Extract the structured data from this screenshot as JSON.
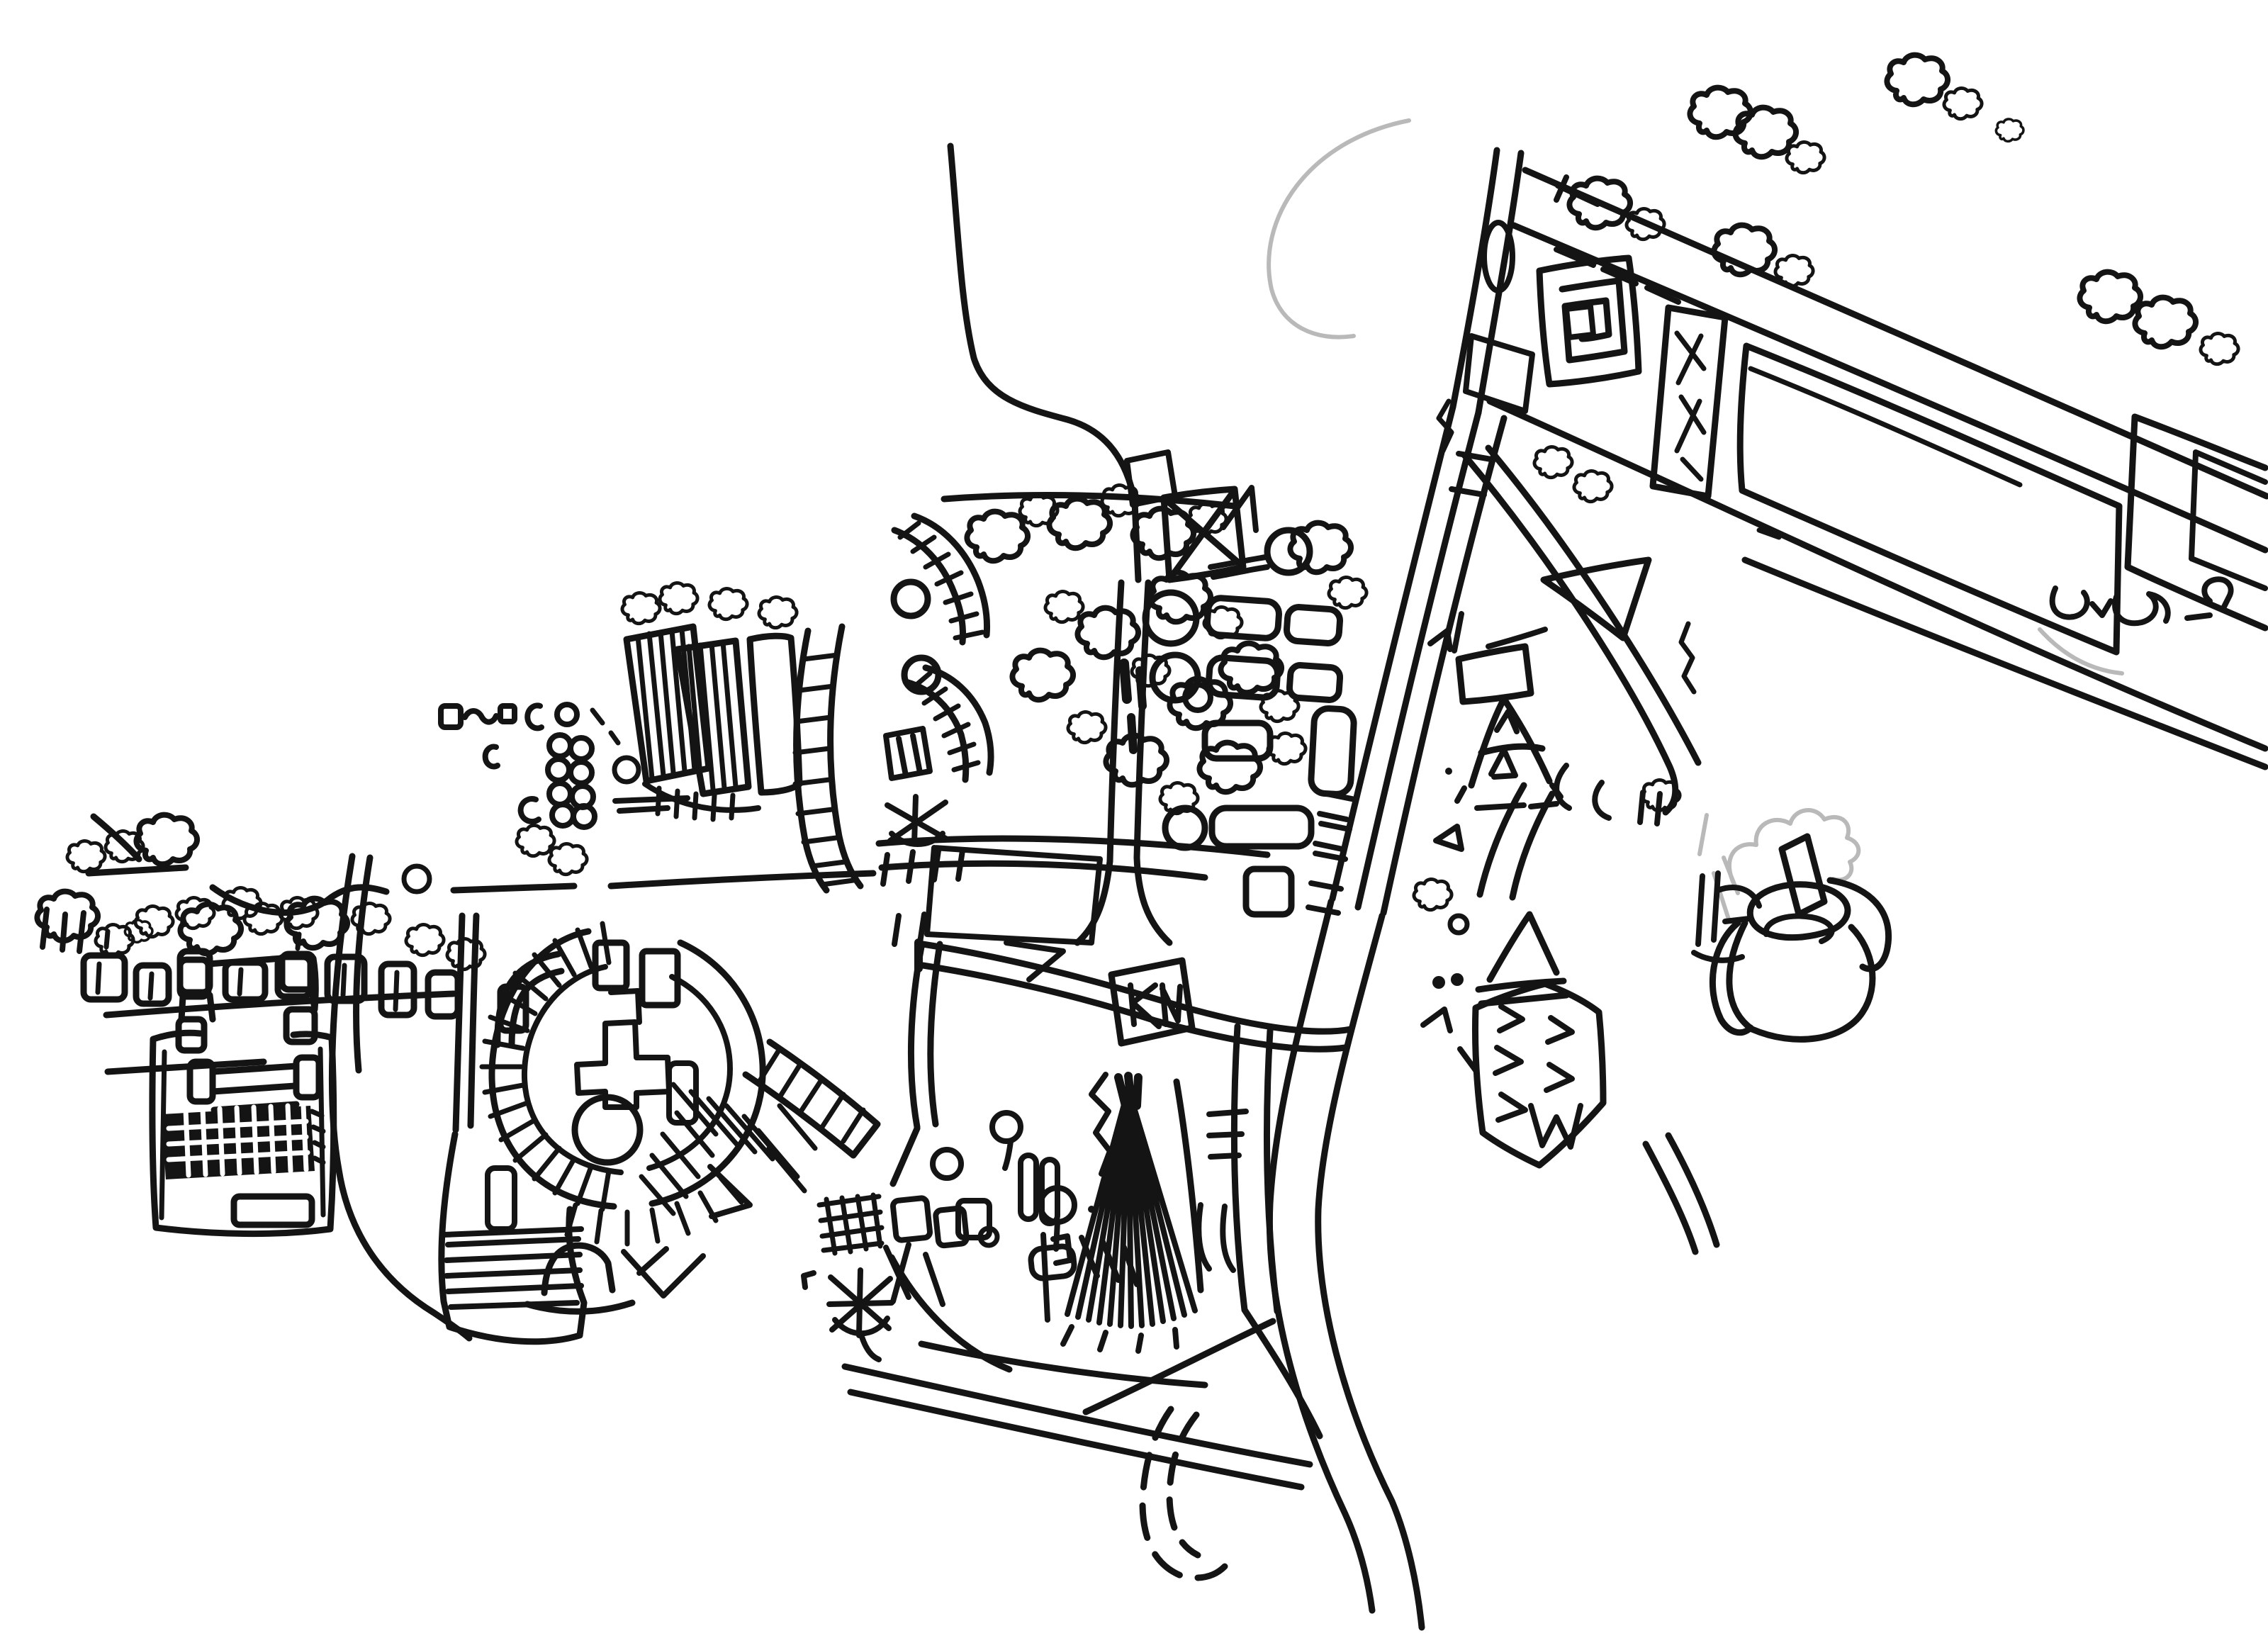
{
  "window": {
    "title": "Hand-drawn aerial map sketch — black ink on white paper"
  },
  "artwork": {
    "type": "freehand ink sketch, plan/aerial view of a town or campus",
    "background_color": "#ffffff",
    "ink_color": "#141414",
    "faint_ink_color": "#b9b9b9"
  },
  "features": [
    {
      "id": "s-curve-road",
      "label": "S-curving road entering from the top"
    },
    {
      "id": "railway-corridor",
      "label": "wide diagonal corridor of parallel lines with tie marks"
    },
    {
      "id": "main-road",
      "label": "double-line road curving to the bottom edge"
    },
    {
      "id": "top-right-boulevard",
      "label": "diagonal tree-lined boulevard band with field parcels"
    },
    {
      "id": "square-spiral-building",
      "label": "square spiral maze-like building"
    },
    {
      "id": "braced-tower",
      "label": "tall narrow building with cross-braced scribbles"
    },
    {
      "id": "field-parcels",
      "label": "large empty rectangular parcels"
    },
    {
      "id": "left-stadium-block",
      "label": "rectangular complex with dark cross-hatched block"
    },
    {
      "id": "cottage-row",
      "label": "row of small houses and bushes along the west road"
    },
    {
      "id": "ring-amphitheatre",
      "label": "circular arena ring with radial hatching"
    },
    {
      "id": "cross-building",
      "label": "cross-shaped building inside the ring"
    },
    {
      "id": "arched-gate",
      "label": "small arched gate below the ring"
    },
    {
      "id": "striped-row-buildings",
      "label": "slanted strip buildings with ribbed hatching"
    },
    {
      "id": "curved-ladder-building",
      "label": "curved ladder-like strip building"
    },
    {
      "id": "fan-esplanade",
      "label": "esplanade with a dark fan of radiating paths"
    },
    {
      "id": "crossed-box",
      "label": "square pavilion crossed with X scribbles"
    },
    {
      "id": "lollipop-cul-de-sac",
      "label": "circle-and-stick cul-de-sac"
    },
    {
      "id": "campus-slabs",
      "label": "rows of rounded slab buildings and round towers"
    },
    {
      "id": "pennant-monument",
      "label": "pennant flag triangle on a pole"
    },
    {
      "id": "a-frame-tower",
      "label": "A-shaped tower structure"
    },
    {
      "id": "triangle-pavilion",
      "label": "large open triangle"
    },
    {
      "id": "hexagram-pavilion",
      "label": "hexagonal pavilion filled with small triangles"
    },
    {
      "id": "road-fork-end",
      "label": "flared road ending with a curl"
    },
    {
      "id": "cooling-tower",
      "label": "round tower with faint smoke plume"
    },
    {
      "id": "asterisk-landmark",
      "label": "asterisk scribble landmark"
    },
    {
      "id": "crosshatch-parcel",
      "label": "small cross-hatched parcel"
    },
    {
      "id": "dashed-hook-road",
      "label": "dashed hook-shaped road"
    },
    {
      "id": "circle-stack",
      "label": "cluster of tiny stacked circles and squares"
    },
    {
      "id": "tree-blobs",
      "label": "scribbled tree and bush blobs"
    },
    {
      "id": "faint-arc",
      "label": "faint partial circle arc near the top"
    }
  ]
}
